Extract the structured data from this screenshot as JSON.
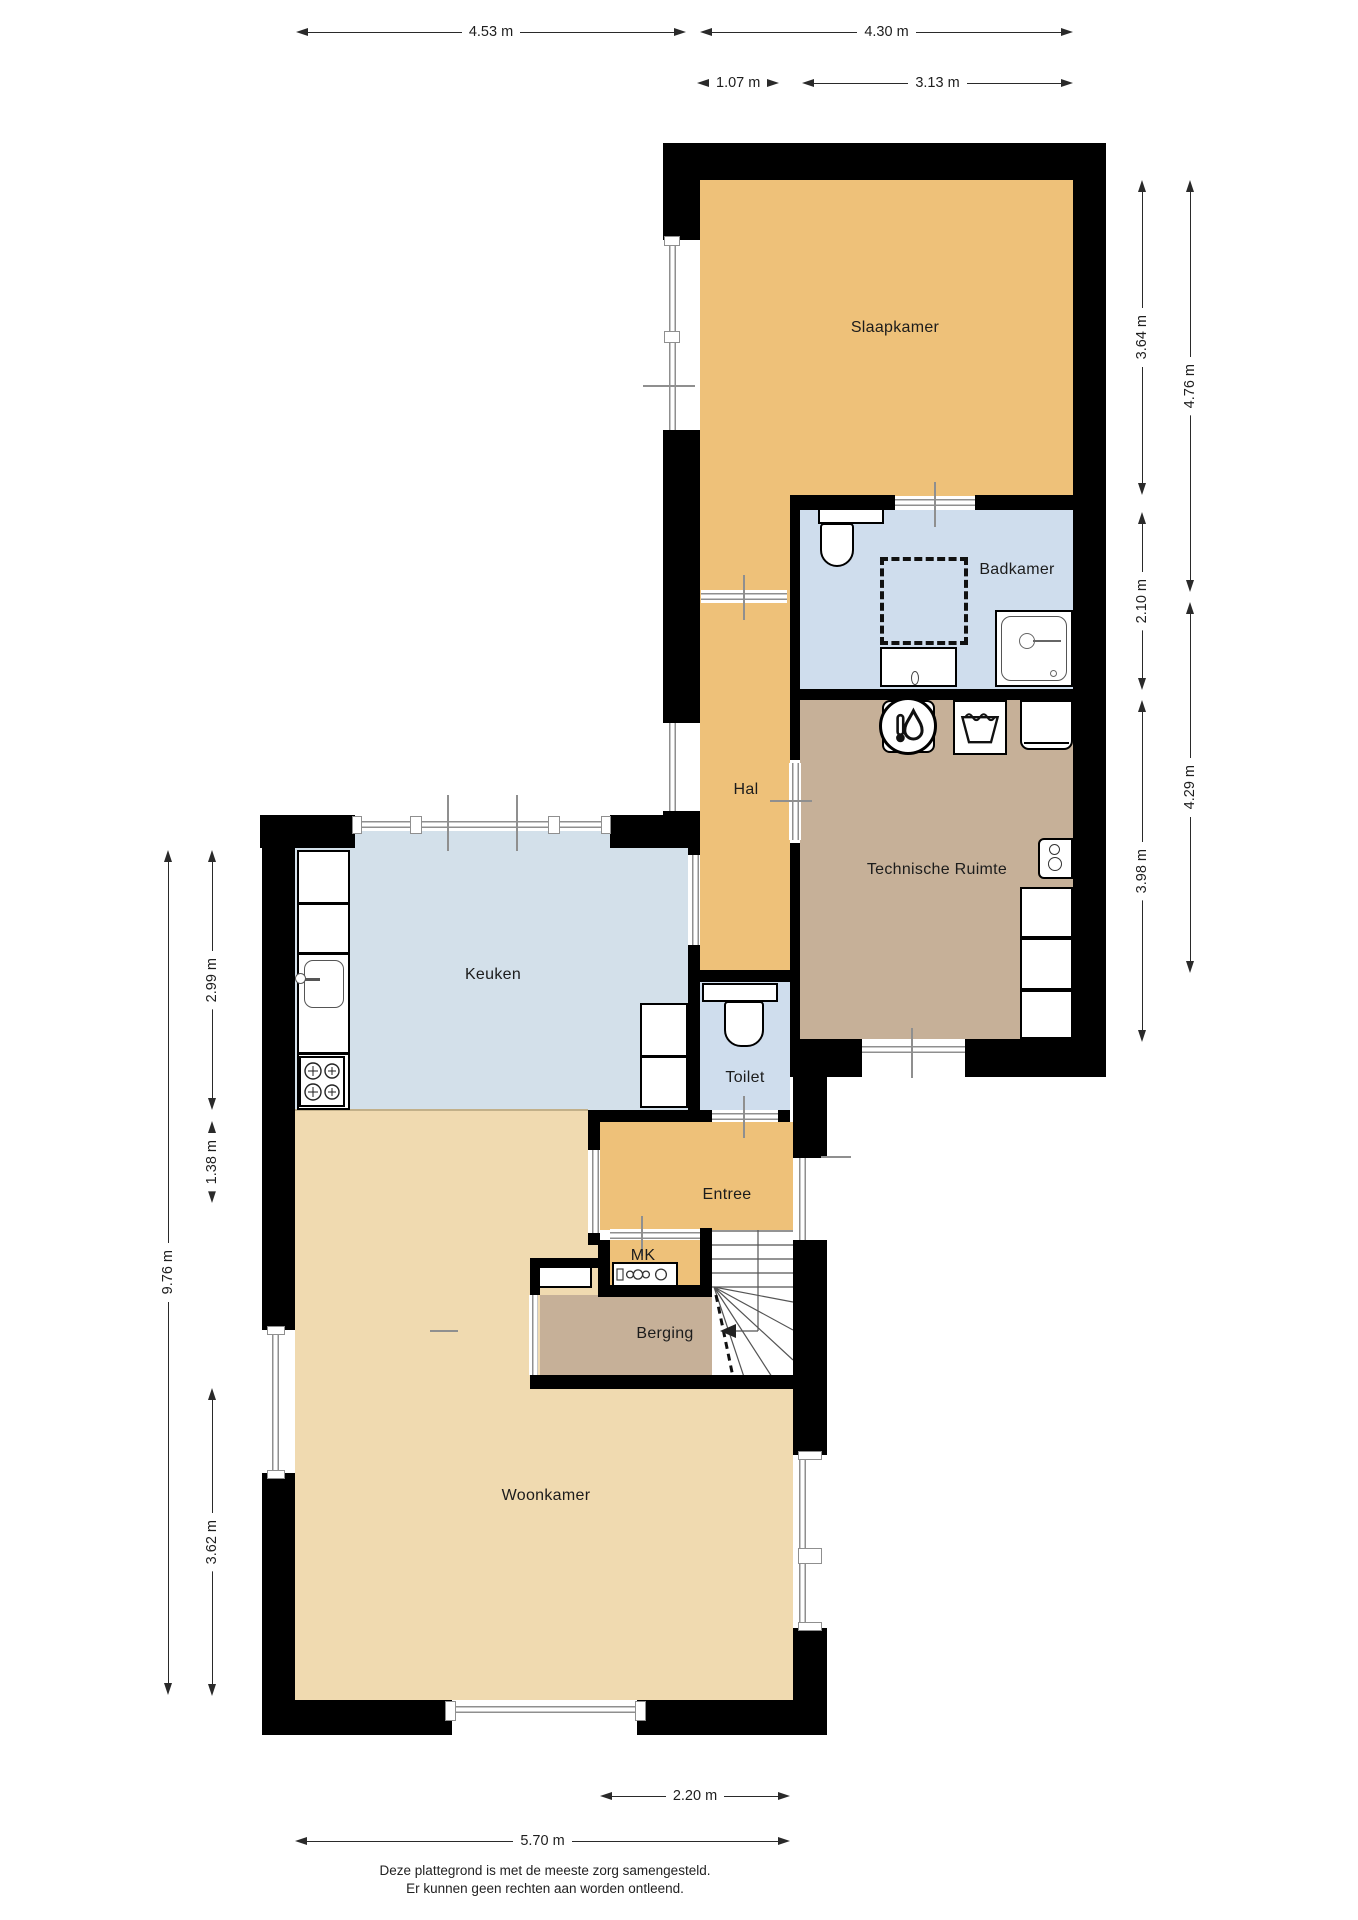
{
  "rooms": [
    {
      "name": "Slaapkamer"
    },
    {
      "name": "Badkamer"
    },
    {
      "name": "Hal"
    },
    {
      "name": "Technische Ruimte"
    },
    {
      "name": "Keuken"
    },
    {
      "name": "Toilet"
    },
    {
      "name": "Entree"
    },
    {
      "name": "MK"
    },
    {
      "name": "Berging"
    },
    {
      "name": "Woonkamer"
    }
  ],
  "dimensions": {
    "top": [
      {
        "label": "4.53 m"
      },
      {
        "label": "4.30 m"
      },
      {
        "label": "1.07 m"
      },
      {
        "label": "3.13 m"
      }
    ],
    "right": [
      {
        "label": "3.64 m"
      },
      {
        "label": "2.10 m"
      },
      {
        "label": "3.98 m"
      },
      {
        "label": "4.76 m"
      },
      {
        "label": "4.29 m"
      }
    ],
    "left": [
      {
        "label": "2.99 m"
      },
      {
        "label": "1.38 m"
      },
      {
        "label": "9.76 m"
      },
      {
        "label": "3.62 m"
      }
    ],
    "bottom": [
      {
        "label": "2.20 m"
      },
      {
        "label": "5.70 m"
      }
    ]
  },
  "footer": {
    "line1": "Deze plattegrond is met de meeste zorg samengesteld.",
    "line2": "Er kunnen geen rechten aan worden ontleend."
  },
  "fixtures": [
    "toilet",
    "shower",
    "washbasin",
    "boiler",
    "washing-machine",
    "dryer",
    "cabinet",
    "kitchen-sink",
    "gas-hob",
    "electric-meter",
    "stairs"
  ],
  "colors": {
    "wall": "#000000",
    "zone_orange": "#eec179",
    "zone_tan": "#f0dab0",
    "zone_brown": "#c6b098",
    "zone_blue": "#cfdded",
    "zone_blue_kitchen": "#d3e0ea",
    "window_line": "#8f8f8f",
    "text": "#1c1c1c"
  }
}
